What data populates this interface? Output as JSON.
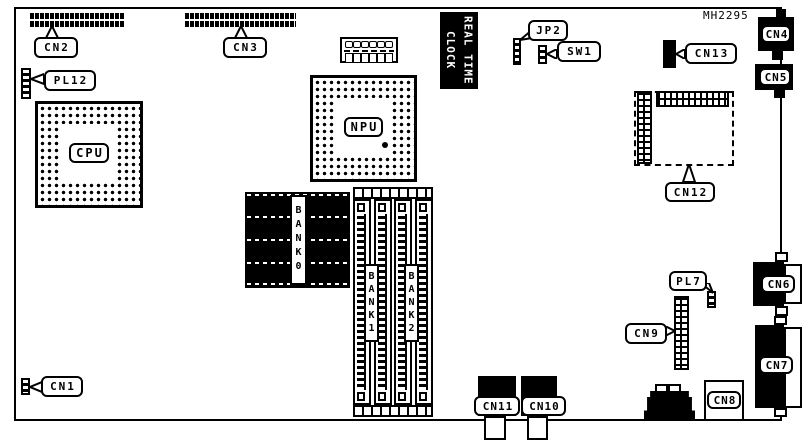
{
  "part_number": "MH2295",
  "labels": {
    "cn1": "CN1",
    "cn2": "CN2",
    "cn3": "CN3",
    "cn4": "CN4",
    "cn5": "CN5",
    "cn6": "CN6",
    "cn7": "CN7",
    "cn8": "CN8",
    "cn9": "CN9",
    "cn10": "CN10",
    "cn11": "CN11",
    "cn12": "CN12",
    "cn13": "CN13",
    "jp2": "JP2",
    "sw1": "SW1",
    "pl7": "PL7",
    "pl12": "PL12",
    "cpu": "CPU",
    "npu": "NPU",
    "bank0": "BANK0",
    "bank1": "BANK1",
    "bank2": "BANK2",
    "rtc": "REAL TIME\nCLOCK"
  },
  "colors": {
    "ink": "#000000",
    "paper": "#ffffff"
  }
}
